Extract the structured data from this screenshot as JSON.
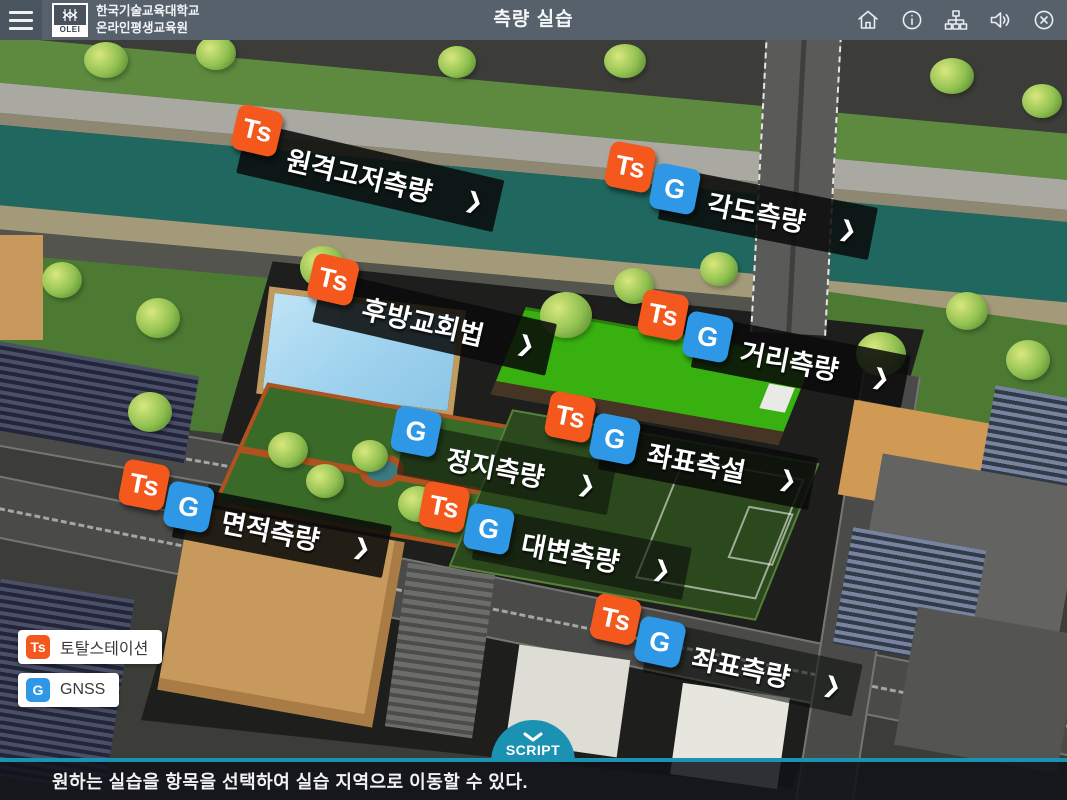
{
  "header": {
    "title": "측량 실습",
    "logo_badge": "OLEI",
    "logo_line1": "한국기술교육대학교",
    "logo_line2": "온라인평생교육원",
    "icons": [
      "menu",
      "home",
      "info",
      "sitemap",
      "sound",
      "close"
    ]
  },
  "ui": {
    "arrow": "❯"
  },
  "map_items": [
    {
      "label": "원격고저측량",
      "badges": [
        "Ts"
      ]
    },
    {
      "label": "각도측량",
      "badges": [
        "Ts",
        "G"
      ]
    },
    {
      "label": "후방교회법",
      "badges": [
        "Ts"
      ]
    },
    {
      "label": "거리측량",
      "badges": [
        "Ts",
        "G"
      ]
    },
    {
      "label": "좌표측설",
      "badges": [
        "Ts",
        "G"
      ]
    },
    {
      "label": "정지측량",
      "badges": [
        "G"
      ]
    },
    {
      "label": "면적측량",
      "badges": [
        "Ts",
        "G"
      ]
    },
    {
      "label": "대변측량",
      "badges": [
        "Ts",
        "G"
      ]
    },
    {
      "label": "좌표측량",
      "badges": [
        "Ts",
        "G"
      ]
    }
  ],
  "legend": [
    {
      "badge": "Ts",
      "label": "토탈스테이션"
    },
    {
      "badge": "G",
      "label": "GNSS"
    }
  ],
  "script_tab": {
    "label": "SCRIPT"
  },
  "footer": {
    "message": "원하는 실습을 항목을 선택하여 실습 지역으로 이동할 수 있다."
  },
  "colors": {
    "ts_badge": "#f4581d",
    "gnss_badge": "#2e97e6",
    "accent_teal": "#1c92b3",
    "topbar": "#57616b",
    "river": "#20675f"
  }
}
